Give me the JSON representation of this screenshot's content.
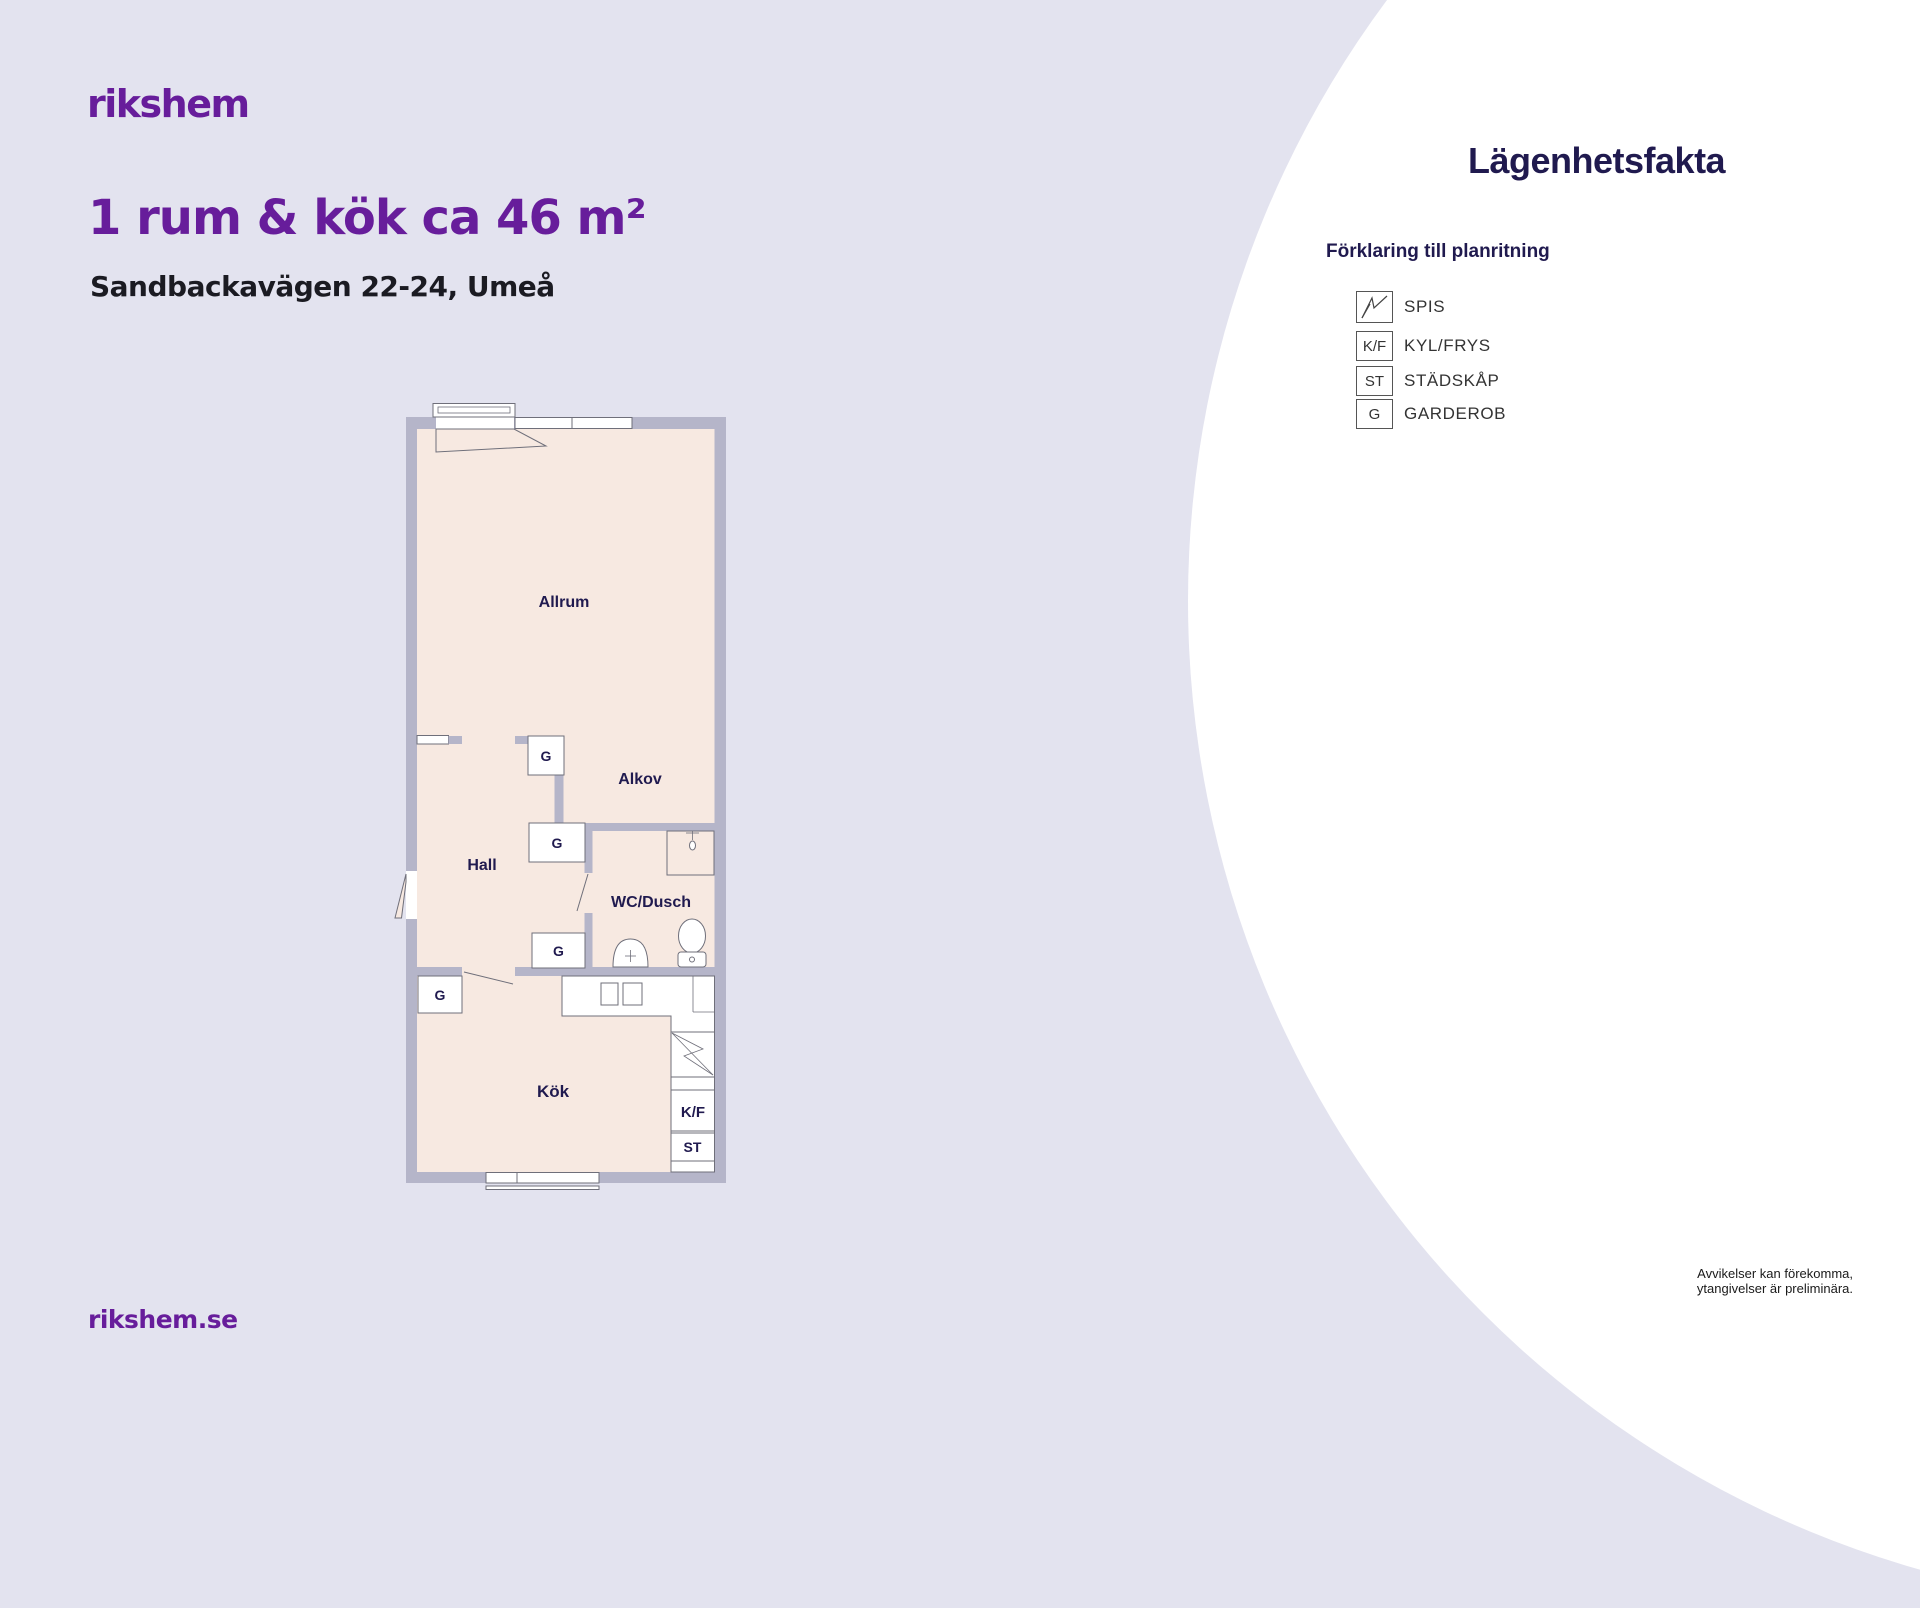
{
  "colors": {
    "bg": "#e3e3ef",
    "purple": "#671d9b",
    "navy": "#201a4f",
    "wall": "#b5b5c9",
    "floor": "#f7e9e1",
    "line": "#6f6f7a",
    "text_dark": "#1b1b22",
    "legend_text": "#333333"
  },
  "brand": {
    "logo_text": "rikshem",
    "website": "rikshem.se"
  },
  "listing": {
    "title": "1 rum & kök ca 46 m²",
    "address": "Sandbackavägen 22-24, Umeå"
  },
  "facts_panel": {
    "title": "Lägenhetsfakta",
    "legend_heading": "Förklaring till planritning",
    "legend": [
      {
        "symbol": "",
        "label": "SPIS"
      },
      {
        "symbol": "K/F",
        "label": "KYL/FRYS"
      },
      {
        "symbol": "ST",
        "label": "STÄDSKÅP"
      },
      {
        "symbol": "G",
        "label": "GARDEROB"
      }
    ]
  },
  "floorplan": {
    "labels": {
      "livingroom": "Allrum",
      "alcove": "Alkov",
      "hall": "Hall",
      "bathroom": "WC/Dusch",
      "kitchen": "Kök",
      "wardrobe": "G",
      "fridge_freezer": "K/F",
      "cleaning_cabinet": "ST"
    }
  },
  "disclaimer": {
    "line1": "Avvikelser kan förekomma,",
    "line2": "ytangivelser är preliminära."
  }
}
